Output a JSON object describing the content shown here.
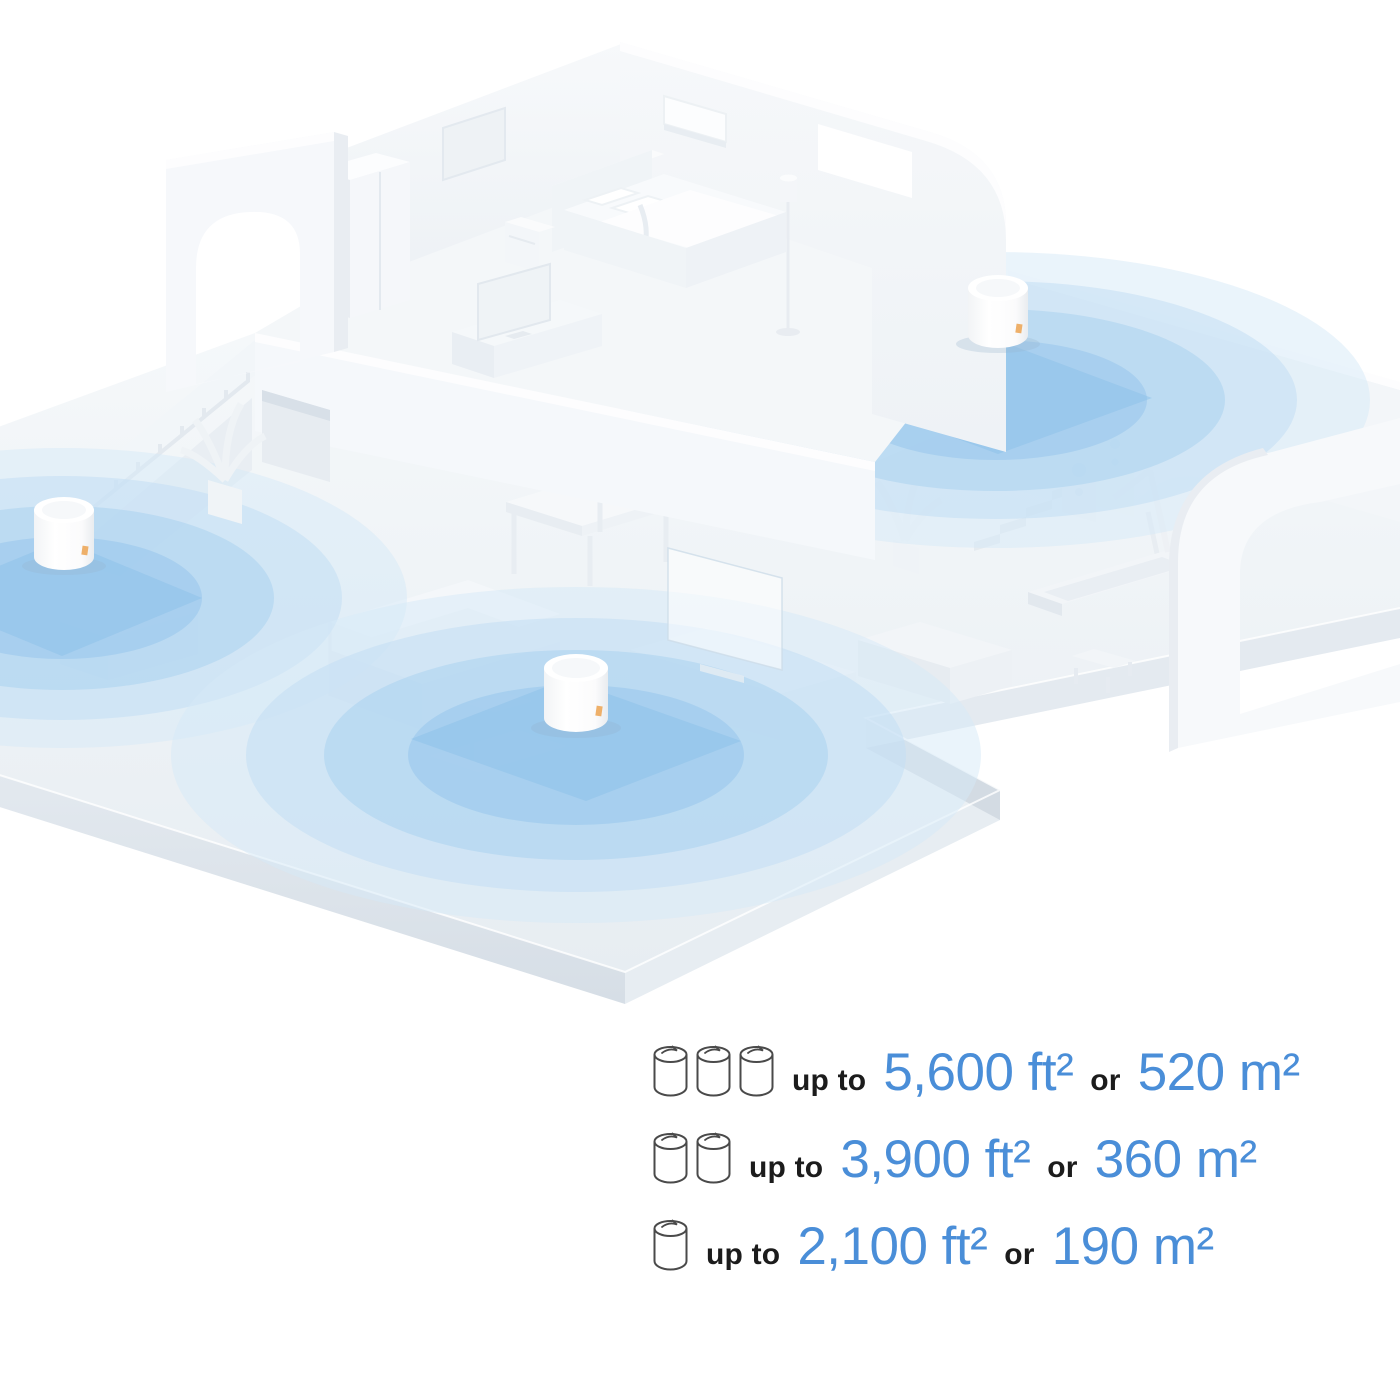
{
  "colors": {
    "accent_blue": "#4a8ed8",
    "text_dark": "#1c1c1c",
    "icon_outline": "#4a4a4a",
    "coverage_blue": "#a9d2ef",
    "floor_gray": "#edf1f5"
  },
  "icons": {
    "unit": "mesh-router-cylinder-icon"
  },
  "scene": {
    "router_units_visible": 3,
    "coverage_zones_visible": 3
  },
  "legend": {
    "rows": [
      {
        "units": 3,
        "up_to": "up to",
        "area_imperial": "5,600 ft²",
        "or": "or",
        "area_metric": "520 m²"
      },
      {
        "units": 2,
        "up_to": "up to",
        "area_imperial": "3,900 ft²",
        "or": "or",
        "area_metric": "360 m²"
      },
      {
        "units": 1,
        "up_to": "up to",
        "area_imperial": "2,100 ft²",
        "or": "or",
        "area_metric": "190 m²"
      }
    ]
  }
}
